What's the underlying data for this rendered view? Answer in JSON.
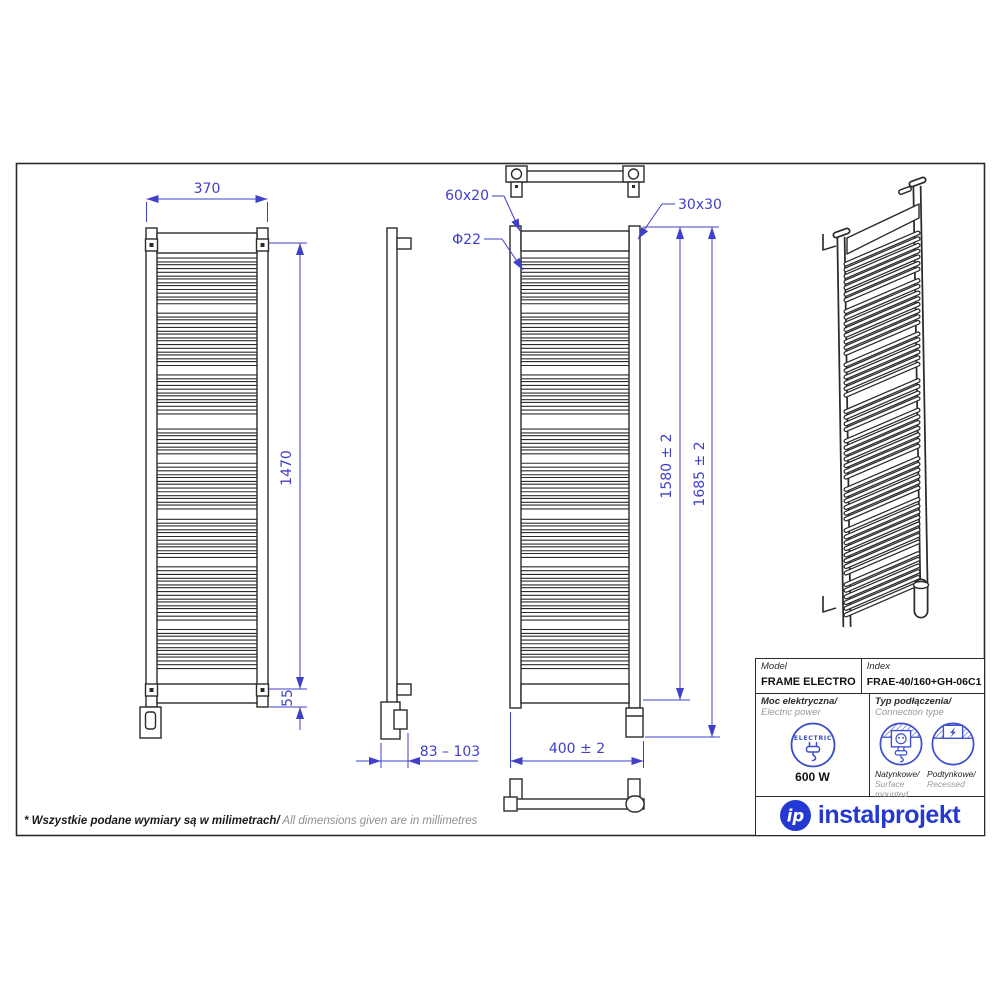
{
  "dims": {
    "front_width": "370",
    "front_height": "1470",
    "bottom_offset": "55",
    "tube_profile_top": "60x20",
    "tube_diameter": "Φ22",
    "post_profile": "30x30",
    "height_inner": "1580 ± 2",
    "height_total": "1685 ± 2",
    "wall_distance": "83 – 103",
    "overall_width": "400 ± 2"
  },
  "table": {
    "model_label": "Model",
    "model_value": "FRAME ELECTRO",
    "index_label": "Index",
    "index_value": "FRAE-40/160+GH-06C1",
    "power_label_pl": "Moc elektryczna/",
    "power_label_en": " Electric power",
    "electric_badge": "ELECTRIC",
    "power_value": "600 W",
    "connection_label_pl": "Typ podłączenia/",
    "connection_label_en": "Connection type",
    "surface_pl": "Natynkowe/",
    "surface_en": "Surface mounted",
    "recessed_pl": "Podtynkowe/",
    "recessed_en": "Recessed"
  },
  "logo": {
    "mark": "ip",
    "text": "instalprojekt"
  },
  "footnote": {
    "pl": "* Wszystkie podane wymiary są w milimetrach/",
    "en": " All dimensions given are in millimetres"
  },
  "colors": {
    "dimension_blue": "#3f3fca",
    "icon_blue": "#3b4ecd",
    "logo_blue": "#2438d2",
    "line_dark": "#2b2b2b"
  }
}
